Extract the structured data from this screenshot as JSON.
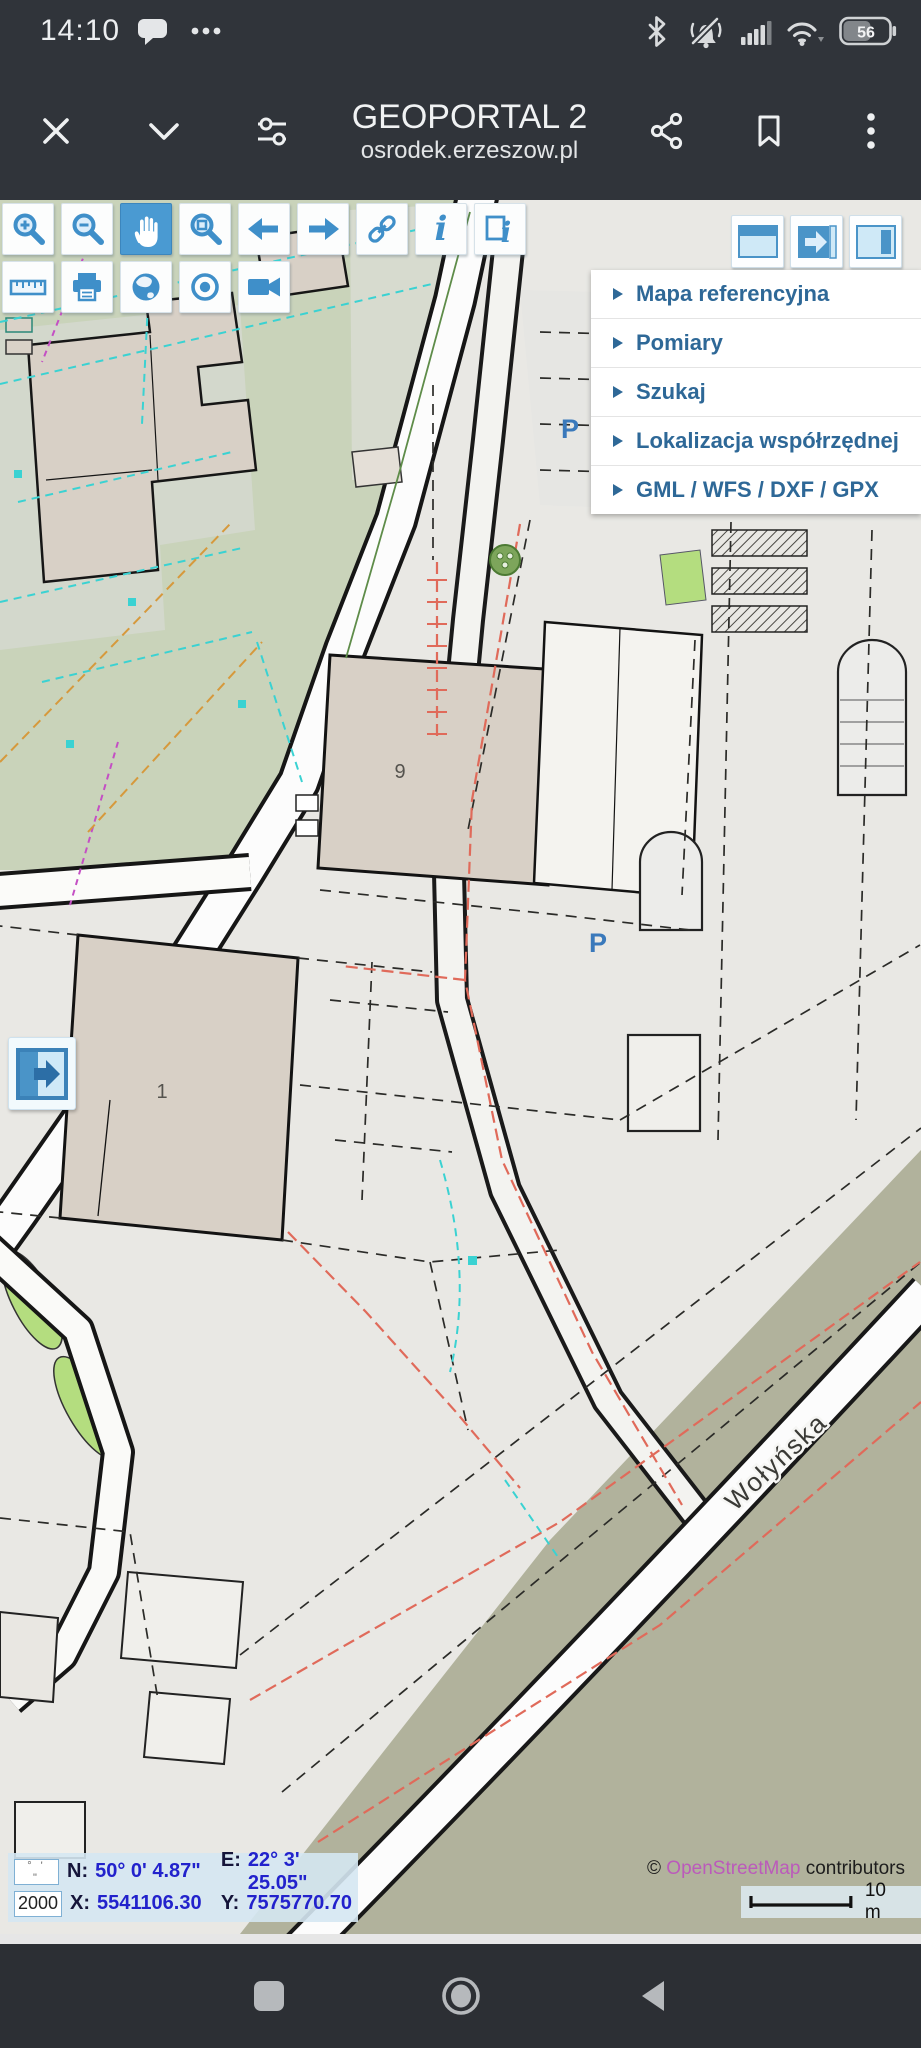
{
  "status_bar": {
    "time": "14:10",
    "battery_percent": "56"
  },
  "header": {
    "title": "GEOPORTAL 2",
    "subtitle": "osrodek.erzeszow.pl"
  },
  "menu": {
    "items": [
      {
        "label": "Mapa referencyjna"
      },
      {
        "label": "Pomiary"
      },
      {
        "label": "Szukaj"
      },
      {
        "label": "Lokalizacja współrzędnej"
      },
      {
        "label": "GML / WFS / DXF / GPX"
      }
    ]
  },
  "coordinates": {
    "dms_toggle": "° ' \"",
    "scale": "2000",
    "n_label": "N:",
    "n_value": "50° 0' 4.87\"",
    "e_label": "E:",
    "e_value": "22° 3' 25.05\"",
    "x_label": "X:",
    "x_value": "5541106.30",
    "y_label": "Y:",
    "y_value": "7575770.70"
  },
  "attribution": {
    "prefix": "©",
    "link": "OpenStreetMap",
    "suffix": "contributors",
    "scale_label": "10 m"
  },
  "map_labels": {
    "building_9": "9",
    "building_1": "1",
    "parking_top": "P",
    "parking_mid": "P",
    "street": "Wołyńska"
  },
  "icons": {
    "info_glyph": "i"
  }
}
